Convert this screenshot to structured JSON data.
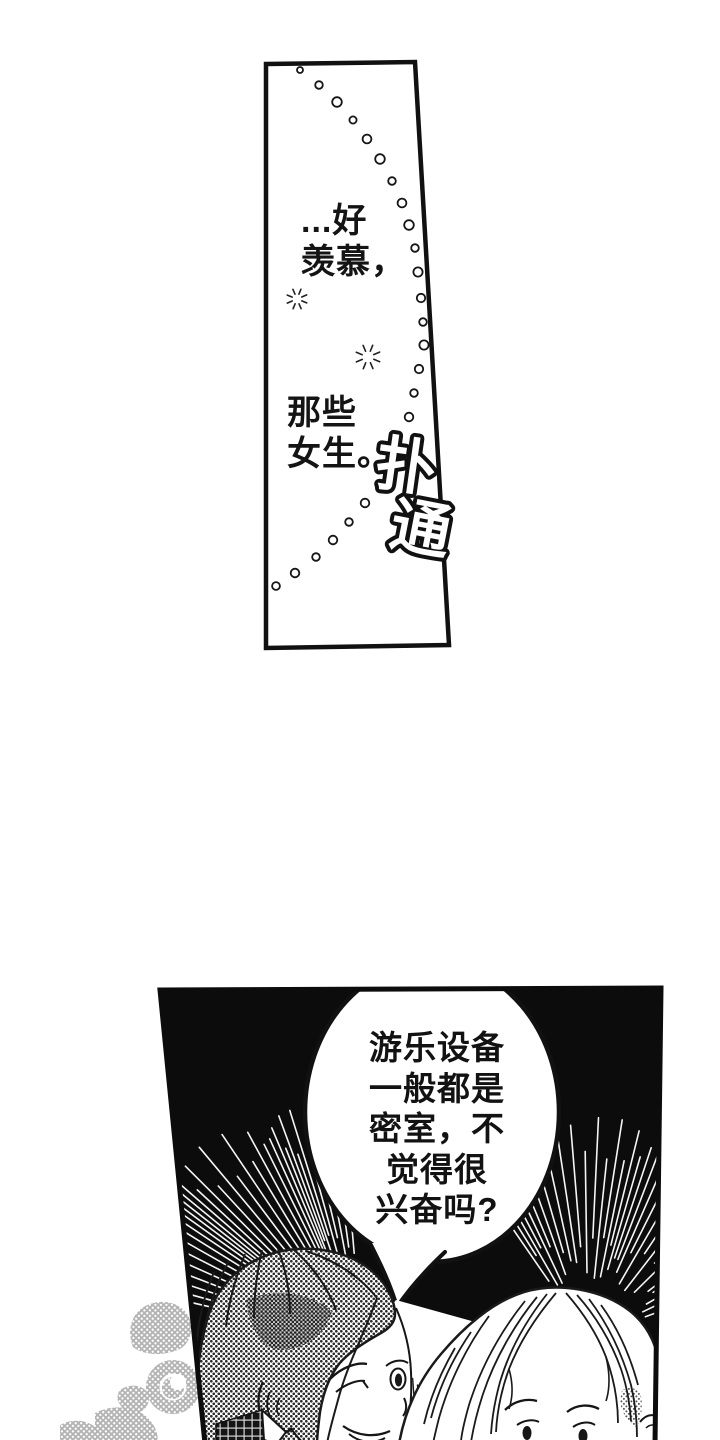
{
  "colors": {
    "paper": "#ffffff",
    "ink": "#111111",
    "panel_black": "#0c0c0c",
    "watermark_gray": "#b4b4b4"
  },
  "top_panel": {
    "monologue": [
      "...好",
      "羡慕，",
      "那些",
      "女生。"
    ],
    "sfx": "扑通"
  },
  "bottom_panel": {
    "speech_bubble": [
      "游乐设备",
      "一般都是",
      "密室，不",
      "觉得很",
      "兴奋吗?"
    ]
  }
}
